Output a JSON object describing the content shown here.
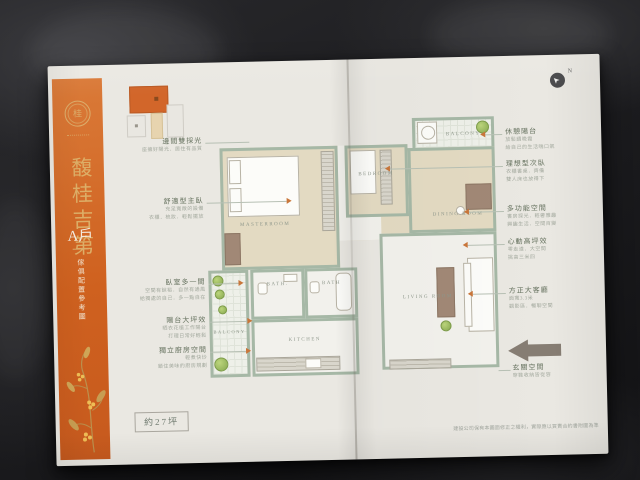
{
  "sidebar": {
    "title": "馥桂吉第",
    "unit": "A戶",
    "note": "傢俱配置參考圖"
  },
  "compass": {
    "label": "N"
  },
  "floorplan": {
    "rooms": {
      "master": "MASTERROOM",
      "bedroom": "BEDROOM",
      "dining": "DINING ROOM",
      "living": "LIVING ROOM",
      "kitchen": "KITCHEN",
      "bath1": "BATH.",
      "bath2": "BATH",
      "balcony_top": "BALCONY",
      "balcony_bottom": "BALCONY"
    }
  },
  "callouts_left": [
    {
      "t": "邊間雙採光",
      "s1": "座擁好陽光．居住有品質"
    },
    {
      "t": "舒適型主臥",
      "s1": "充足寬敞的設備",
      "s2": "衣櫃．梳妝．輕鬆擺放"
    },
    {
      "t": "臥室多一間",
      "s1": "空間有餘裕．自然有通風",
      "s2": "給獨處的自己．多一點自在"
    },
    {
      "t": "陽台大坪效",
      "s1": "晒衣花植工作陽台",
      "s2": "打理日常好輕鬆"
    },
    {
      "t": "獨立廚房空間",
      "s1": "輕煮快炒",
      "s2": "鎖住美味的廚房規劃"
    }
  ],
  "callouts_right": [
    {
      "t": "休憩陽台",
      "s1": "放鬆讀晚霞",
      "s2": "給自己的生活喘口氣"
    },
    {
      "t": "理想型次臥",
      "s1": "衣櫃書桌．齊備",
      "s2": "雙人床也放得下"
    },
    {
      "t": "多功能空間",
      "s1": "書房採光．輕奢雅趣",
      "s2": "興趣生活．空間百變"
    },
    {
      "t": "心動高坪效",
      "s1": "零走道．大空間",
      "s2": "挑高三米四"
    },
    {
      "t": "方正大客廳",
      "s1": "面寬3.3米",
      "s2": "觀影區．暢聊空間"
    },
    {
      "t": "玄關空間",
      "s1": "穿鞋收納皆從容"
    }
  ],
  "footer": {
    "area": "約27坪",
    "disclaimer": "建設公司保有本圖面修正之權利，實際應以買賣合約書附圖為準"
  },
  "colors": {
    "accent_orange": "#d2662a",
    "gold": "#ddae67",
    "wall_green": "#a6b8a6",
    "floor_beige": "#e3dac2",
    "paper": "#eae8e2",
    "leather": "#1b1b1d",
    "entry_arrow_taupe": "#867d73",
    "callout_arrow_orange": "#c9763a"
  }
}
